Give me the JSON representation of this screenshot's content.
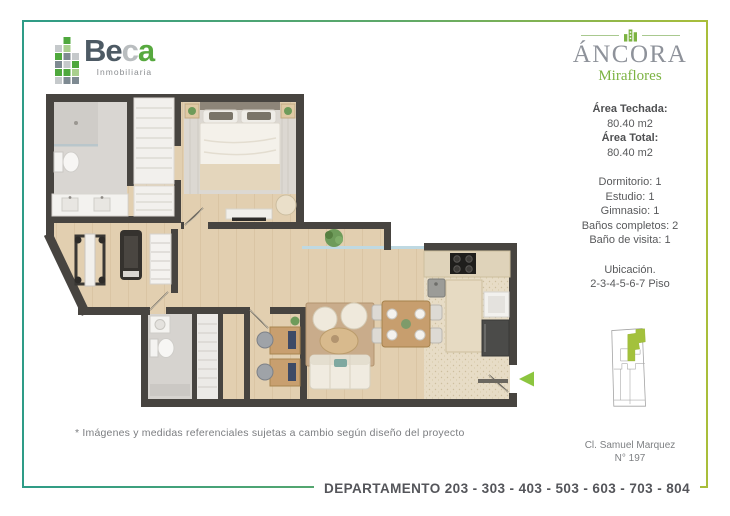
{
  "header": {
    "beca": {
      "word_be": "Be",
      "word_c": "c",
      "word_a": "a",
      "tagline": "Inmobiliaria"
    },
    "ancora": {
      "name": "ÁNCORA",
      "sub": "Miraflores"
    }
  },
  "sidebar": {
    "area_covered_label": "Área Techada:",
    "area_covered_value": "80.40 m2",
    "area_total_label": "Área Total:",
    "area_total_value": "80.40 m2",
    "features": [
      "Dormitorio: 1",
      "Estudio: 1",
      "Gimnasio: 1",
      "Baños completos: 2",
      "Baño de visita: 1"
    ],
    "location_label": "Ubicación.",
    "location_floors": "2-3-4-5-6-7 Piso",
    "address_line1": "Cl. Samuel Marquez",
    "address_line2": "N° 197"
  },
  "footer": {
    "label": "DEPARTAMENTO 203 - 303 - 403 - 503 - 603 - 703 - 804"
  },
  "note": "* Imágenes y medidas referenciales sujetas a cambio según diseño del proyecto",
  "colors": {
    "teal": "#2E9C87",
    "lime": "#A9BE3A",
    "brand_green": "#7CB342",
    "diagram_green": "#A3C13C",
    "wall": "#474440",
    "text": "#58595B"
  }
}
